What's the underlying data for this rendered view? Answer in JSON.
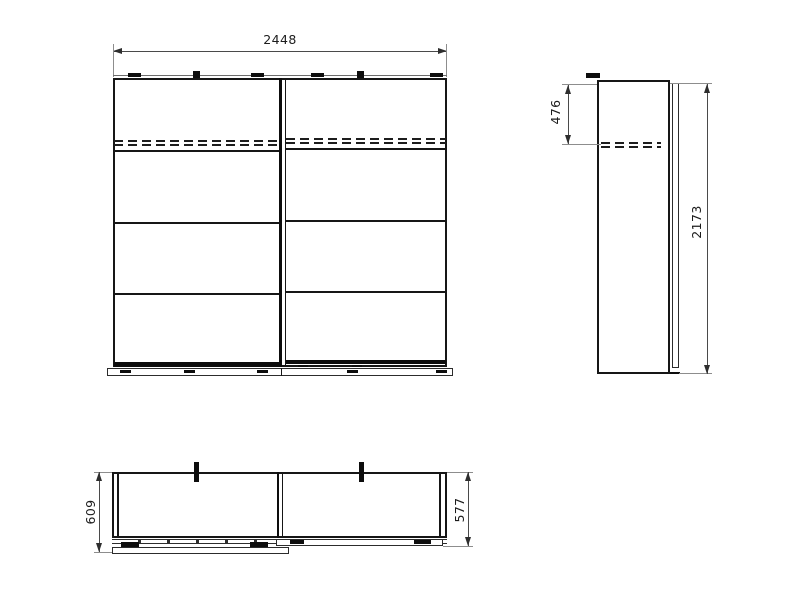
{
  "drawing": {
    "background": "#ffffff",
    "outline_color": "#161616",
    "dimension_color": "#4a4a4a",
    "front_view": {
      "width_dim": "2448"
    },
    "side_view": {
      "shelf_height_dim": "476",
      "height_dim": "2173"
    },
    "top_view": {
      "depth_total_dim": "609",
      "depth_dim": "577"
    }
  }
}
